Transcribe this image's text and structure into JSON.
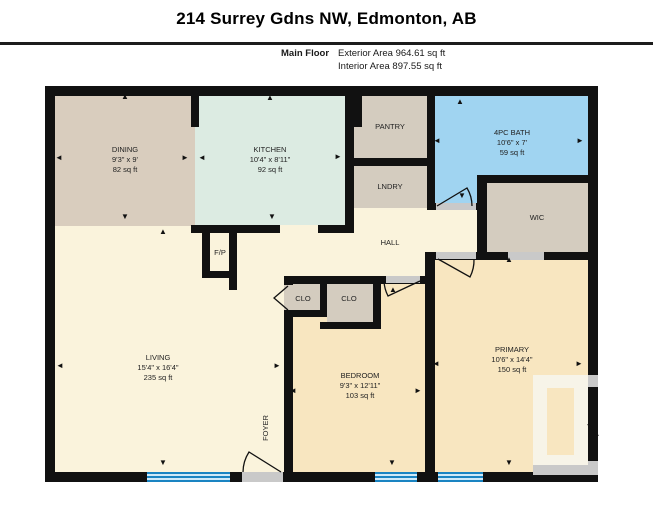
{
  "header": {
    "title": "214 Surrey Gdns NW, Edmonton, AB",
    "floor_label": "Main Floor",
    "exterior_area": "Exterior Area 964.61 sq ft",
    "interior_area": "Interior Area 897.55 sq ft"
  },
  "rooms": {
    "dining": {
      "name": "DINING",
      "dims": "9'3\" x 9'",
      "area": "82 sq ft"
    },
    "kitchen": {
      "name": "KITCHEN",
      "dims": "10'4\" x 8'11\"",
      "area": "92 sq ft"
    },
    "bath": {
      "name": "4PC BATH",
      "dims": "10'6\" x 7'",
      "area": "59 sq ft"
    },
    "living": {
      "name": "LIVING",
      "dims": "15'4\" x 16'4\"",
      "area": "235 sq ft"
    },
    "bedroom": {
      "name": "BEDROOM",
      "dims": "9'3\" x 12'11\"",
      "area": "103 sq ft"
    },
    "primary": {
      "name": "PRIMARY",
      "dims": "10'6\" x 14'4\"",
      "area": "150 sq ft"
    },
    "pantry": {
      "name": "PANTRY"
    },
    "laundry": {
      "name": "LNDRY"
    },
    "wic": {
      "name": "WIC"
    },
    "hall": {
      "name": "HALL"
    },
    "fireplace": {
      "name": "F/P"
    },
    "closet1": {
      "name": "CLO"
    },
    "closet2": {
      "name": "CLO"
    },
    "foyer": {
      "name": "FOYER"
    }
  },
  "icons": {
    "arrow_up": "▲",
    "arrow_down": "▼",
    "arrow_left": "◄",
    "arrow_right": "►"
  },
  "colors": {
    "wall": "#111111",
    "cream": "#faf3dc",
    "dining_tan": "#d9cdbe",
    "kitchen_green": "#dcebe2",
    "closet_tan": "#d4ccbf",
    "bath_blue": "#a0d4f1",
    "peach": "#f8e6c0",
    "window_blue": "#1a84c2",
    "window_light": "#cfe9f8",
    "opening": "#c9c9c9"
  }
}
